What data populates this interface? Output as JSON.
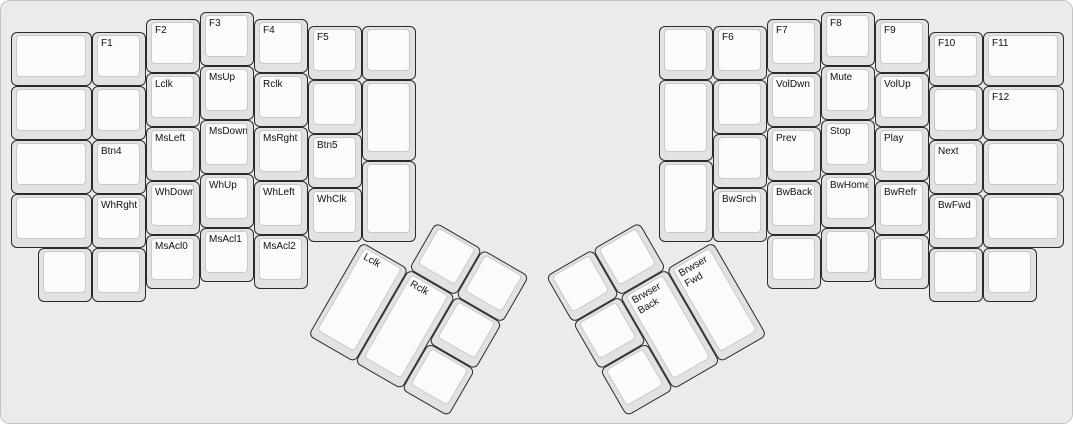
{
  "app": {
    "title": "ErgoDox media and mouse keys layer layout"
  },
  "canvas": {
    "bg": "#ebebeb",
    "border_color": "#c4c4c4",
    "key_color": "#e2e2e2",
    "keycap_color": "#fbfbfb",
    "key_border_color": "#2a2a2a",
    "keycap_border_color": "#c9c9c9",
    "text_color": "#111111",
    "unit_px": 54
  },
  "clusters": {
    "left_main": {
      "origin_x": 10,
      "origin_y": 11,
      "rotation": 0,
      "keys": [
        {
          "x": 0,
          "y": 0.375,
          "w": 1.5,
          "h": 1,
          "label": ""
        },
        {
          "x": 0,
          "y": 1.375,
          "w": 1.5,
          "h": 1,
          "label": ""
        },
        {
          "x": 0,
          "y": 2.375,
          "w": 1.5,
          "h": 1,
          "label": ""
        },
        {
          "x": 0,
          "y": 3.375,
          "w": 1.5,
          "h": 1,
          "label": ""
        },
        {
          "x": 1.5,
          "y": 0.375,
          "w": 1,
          "h": 1,
          "label": "F1"
        },
        {
          "x": 1.5,
          "y": 1.375,
          "w": 1,
          "h": 1,
          "label": ""
        },
        {
          "x": 1.5,
          "y": 2.375,
          "w": 1,
          "h": 1,
          "label": "Btn4"
        },
        {
          "x": 1.5,
          "y": 3.375,
          "w": 1,
          "h": 1,
          "label": "WhRght"
        },
        {
          "x": 2.5,
          "y": 0.125,
          "w": 1,
          "h": 1,
          "label": "F2"
        },
        {
          "x": 2.5,
          "y": 1.125,
          "w": 1,
          "h": 1,
          "label": "Lclk"
        },
        {
          "x": 2.5,
          "y": 2.125,
          "w": 1,
          "h": 1,
          "label": "MsLeft"
        },
        {
          "x": 2.5,
          "y": 3.125,
          "w": 1,
          "h": 1,
          "label": "WhDown"
        },
        {
          "x": 3.5,
          "y": 0,
          "w": 1,
          "h": 1,
          "label": "F3"
        },
        {
          "x": 3.5,
          "y": 1,
          "w": 1,
          "h": 1,
          "label": "MsUp"
        },
        {
          "x": 3.5,
          "y": 2,
          "w": 1,
          "h": 1,
          "label": "MsDown"
        },
        {
          "x": 3.5,
          "y": 3,
          "w": 1,
          "h": 1,
          "label": "WhUp"
        },
        {
          "x": 4.5,
          "y": 0.125,
          "w": 1,
          "h": 1,
          "label": "F4"
        },
        {
          "x": 4.5,
          "y": 1.125,
          "w": 1,
          "h": 1,
          "label": "Rclk"
        },
        {
          "x": 4.5,
          "y": 2.125,
          "w": 1,
          "h": 1,
          "label": "MsRght"
        },
        {
          "x": 4.5,
          "y": 3.125,
          "w": 1,
          "h": 1,
          "label": "WhLeft"
        },
        {
          "x": 5.5,
          "y": 0.25,
          "w": 1,
          "h": 1,
          "label": "F5"
        },
        {
          "x": 5.5,
          "y": 1.25,
          "w": 1,
          "h": 1,
          "label": ""
        },
        {
          "x": 5.5,
          "y": 2.25,
          "w": 1,
          "h": 1,
          "label": "Btn5"
        },
        {
          "x": 5.5,
          "y": 3.25,
          "w": 1,
          "h": 1,
          "label": "WhClk"
        },
        {
          "x": 6.5,
          "y": 0.25,
          "w": 1,
          "h": 1,
          "label": ""
        },
        {
          "x": 6.5,
          "y": 1.25,
          "w": 1,
          "h": 1.5,
          "label": ""
        },
        {
          "x": 6.5,
          "y": 2.75,
          "w": 1,
          "h": 1.5,
          "label": ""
        },
        {
          "x": 0.5,
          "y": 4.375,
          "w": 1,
          "h": 1,
          "label": ""
        },
        {
          "x": 1.5,
          "y": 4.375,
          "w": 1,
          "h": 1,
          "label": ""
        },
        {
          "x": 2.5,
          "y": 4.125,
          "w": 1,
          "h": 1,
          "label": "MsAcl0"
        },
        {
          "x": 3.5,
          "y": 4,
          "w": 1,
          "h": 1,
          "label": "MsAcl1"
        },
        {
          "x": 4.5,
          "y": 4.125,
          "w": 1,
          "h": 1,
          "label": "MsAcl2"
        }
      ]
    },
    "left_thumb": {
      "origin_x": 361,
      "origin_y": 240.5,
      "rotation": 30,
      "keys": [
        {
          "x": 1,
          "y": -1,
          "w": 1,
          "h": 1,
          "label": ""
        },
        {
          "x": 2,
          "y": -1,
          "w": 1,
          "h": 1,
          "label": ""
        },
        {
          "x": 0,
          "y": 0,
          "w": 1,
          "h": 2,
          "label": "Lclk"
        },
        {
          "x": 1,
          "y": 0,
          "w": 1,
          "h": 2,
          "label": "Rclk"
        },
        {
          "x": 2,
          "y": 0,
          "w": 1,
          "h": 1,
          "label": ""
        },
        {
          "x": 2,
          "y": 1,
          "w": 1,
          "h": 1,
          "label": ""
        }
      ]
    },
    "right_main": {
      "origin_x": 658,
      "origin_y": 11,
      "rotation": 0,
      "keys": [
        {
          "x": 0,
          "y": 0.25,
          "w": 1,
          "h": 1,
          "label": ""
        },
        {
          "x": 0,
          "y": 1.25,
          "w": 1,
          "h": 1.5,
          "label": ""
        },
        {
          "x": 0,
          "y": 2.75,
          "w": 1,
          "h": 1.5,
          "label": ""
        },
        {
          "x": 1,
          "y": 0.25,
          "w": 1,
          "h": 1,
          "label": "F6"
        },
        {
          "x": 1,
          "y": 1.25,
          "w": 1,
          "h": 1,
          "label": ""
        },
        {
          "x": 1,
          "y": 2.25,
          "w": 1,
          "h": 1,
          "label": ""
        },
        {
          "x": 1,
          "y": 3.25,
          "w": 1,
          "h": 1,
          "label": "BwSrch"
        },
        {
          "x": 2,
          "y": 0.125,
          "w": 1,
          "h": 1,
          "label": "F7"
        },
        {
          "x": 2,
          "y": 1.125,
          "w": 1,
          "h": 1,
          "label": "VolDwn"
        },
        {
          "x": 2,
          "y": 2.125,
          "w": 1,
          "h": 1,
          "label": "Prev"
        },
        {
          "x": 2,
          "y": 3.125,
          "w": 1,
          "h": 1,
          "label": "BwBack"
        },
        {
          "x": 3,
          "y": 0,
          "w": 1,
          "h": 1,
          "label": "F8"
        },
        {
          "x": 3,
          "y": 1,
          "w": 1,
          "h": 1,
          "label": "Mute"
        },
        {
          "x": 3,
          "y": 2,
          "w": 1,
          "h": 1,
          "label": "Stop"
        },
        {
          "x": 3,
          "y": 3,
          "w": 1,
          "h": 1,
          "label": "BwHome"
        },
        {
          "x": 4,
          "y": 0.125,
          "w": 1,
          "h": 1,
          "label": "F9"
        },
        {
          "x": 4,
          "y": 1.125,
          "w": 1,
          "h": 1,
          "label": "VolUp"
        },
        {
          "x": 4,
          "y": 2.125,
          "w": 1,
          "h": 1,
          "label": "Play"
        },
        {
          "x": 4,
          "y": 3.125,
          "w": 1,
          "h": 1,
          "label": "BwRefr"
        },
        {
          "x": 5,
          "y": 0.375,
          "w": 1,
          "h": 1,
          "label": "F10"
        },
        {
          "x": 5,
          "y": 1.375,
          "w": 1,
          "h": 1,
          "label": ""
        },
        {
          "x": 5,
          "y": 2.375,
          "w": 1,
          "h": 1,
          "label": "Next"
        },
        {
          "x": 5,
          "y": 3.375,
          "w": 1,
          "h": 1,
          "label": "BwFwd"
        },
        {
          "x": 6,
          "y": 0.375,
          "w": 1.5,
          "h": 1,
          "label": "F11"
        },
        {
          "x": 6,
          "y": 1.375,
          "w": 1.5,
          "h": 1,
          "label": "F12"
        },
        {
          "x": 6,
          "y": 2.375,
          "w": 1.5,
          "h": 1,
          "label": ""
        },
        {
          "x": 6,
          "y": 3.375,
          "w": 1.5,
          "h": 1,
          "label": ""
        },
        {
          "x": 2,
          "y": 4.125,
          "w": 1,
          "h": 1,
          "label": ""
        },
        {
          "x": 3,
          "y": 4,
          "w": 1,
          "h": 1,
          "label": ""
        },
        {
          "x": 4,
          "y": 4.125,
          "w": 1,
          "h": 1,
          "label": ""
        },
        {
          "x": 5,
          "y": 4.375,
          "w": 1,
          "h": 1,
          "label": ""
        },
        {
          "x": 6,
          "y": 4.375,
          "w": 1,
          "h": 1,
          "label": ""
        }
      ]
    },
    "right_thumb": {
      "origin_x": 712,
      "origin_y": 240.5,
      "rotation": -30,
      "keys": [
        {
          "x": -3,
          "y": -1,
          "w": 1,
          "h": 1,
          "label": ""
        },
        {
          "x": -2,
          "y": -1,
          "w": 1,
          "h": 1,
          "label": ""
        },
        {
          "x": -3,
          "y": 0,
          "w": 1,
          "h": 1,
          "label": ""
        },
        {
          "x": -2,
          "y": 0,
          "w": 1,
          "h": 2,
          "label": "Brwser\nBack"
        },
        {
          "x": -1,
          "y": 0,
          "w": 1,
          "h": 2,
          "label": "Brwser\nFwd"
        },
        {
          "x": -3,
          "y": 1,
          "w": 1,
          "h": 1,
          "label": ""
        }
      ]
    }
  }
}
